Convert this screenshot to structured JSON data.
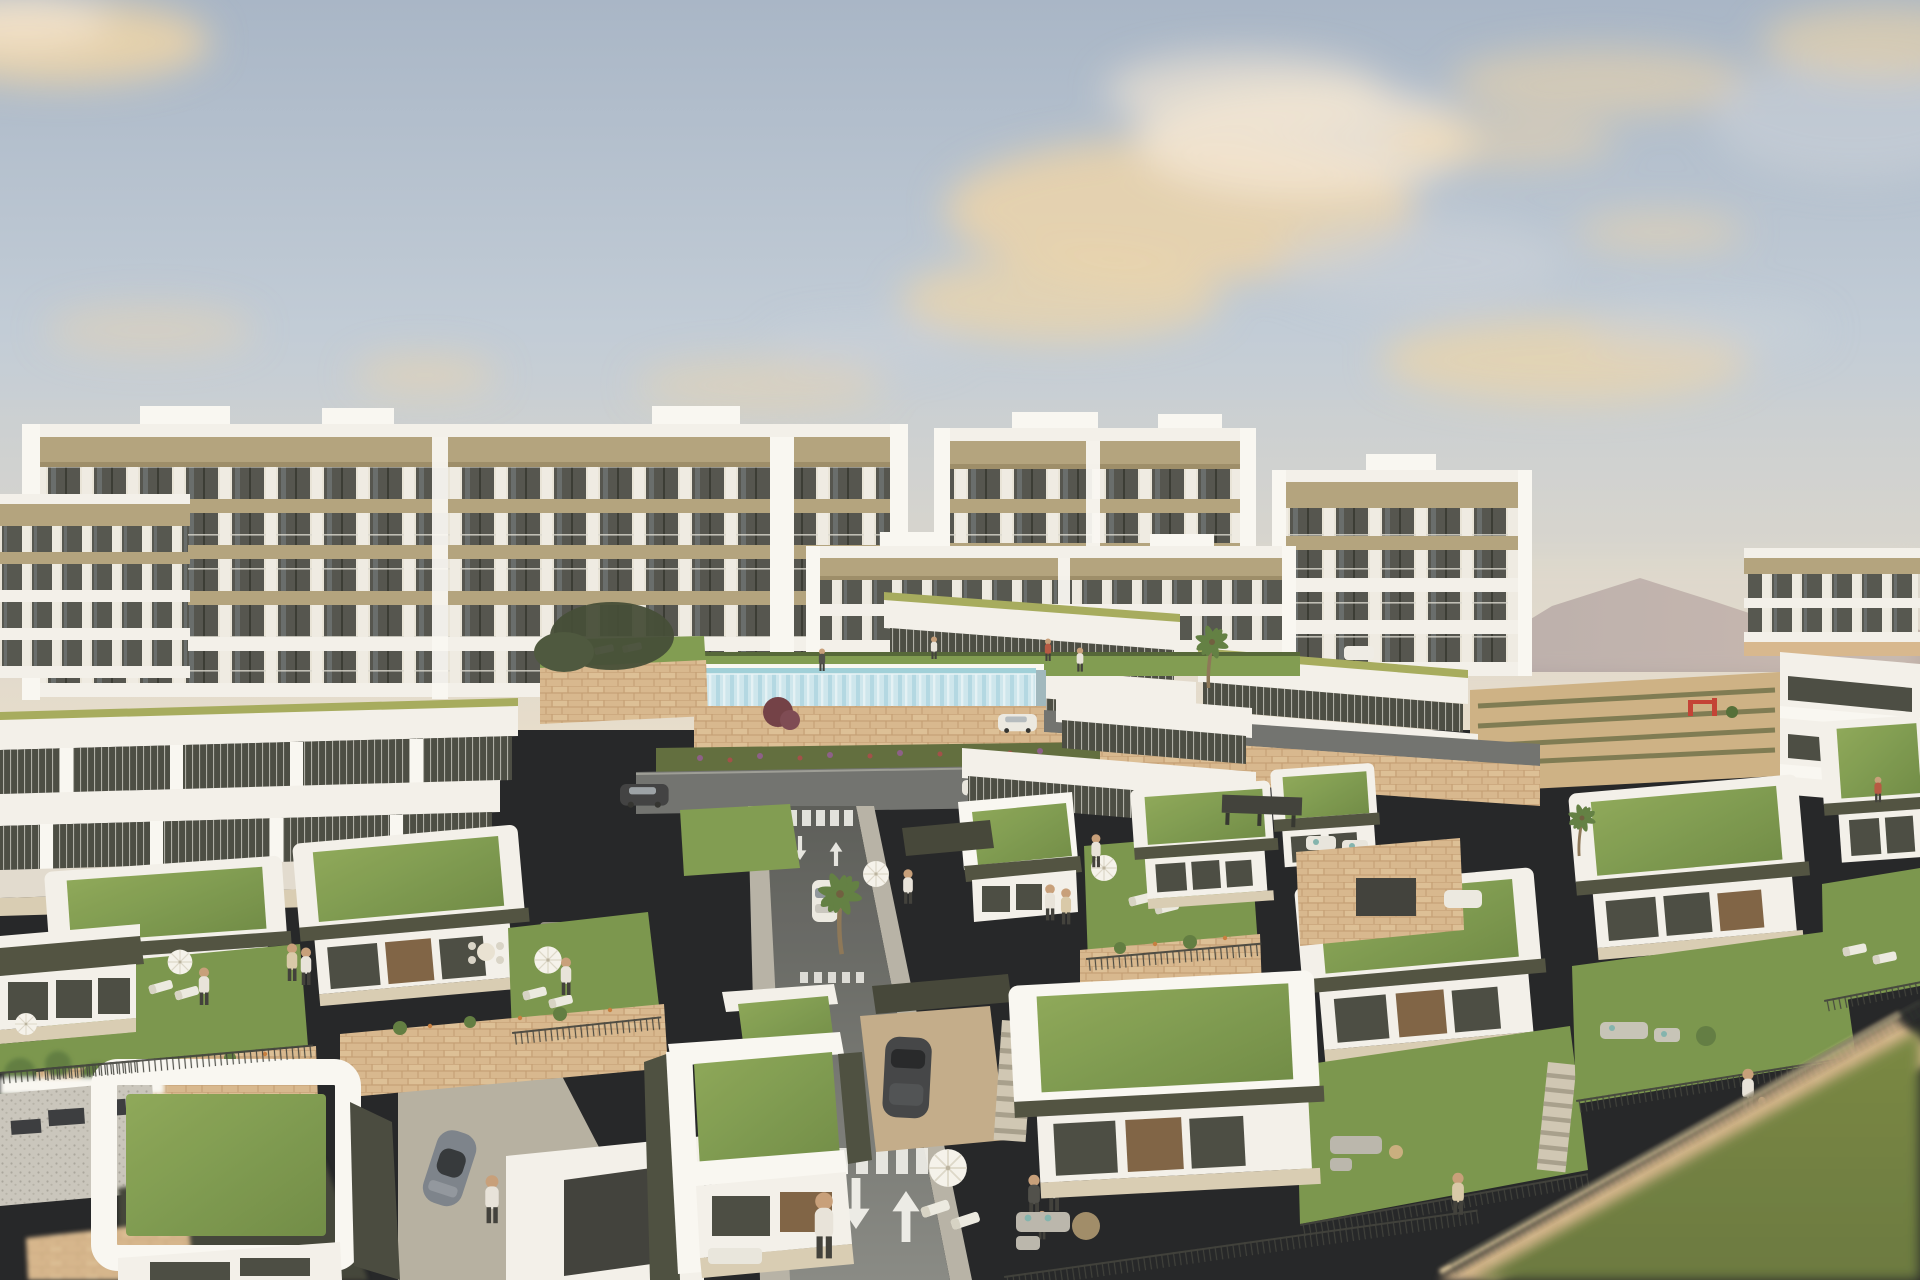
{
  "scene": {
    "title": "Aerial architectural rendering of a hillside residential resort at golden hour",
    "type": "3D exterior visualization",
    "time_of_day": "late afternoon, golden hour",
    "weather": "partly cloudy with warm-lit clouds",
    "view": "elevated three-quarter aerial view"
  },
  "palette": {
    "sky_top": "#a9b6c6",
    "sky_mid": "#c2ccd6",
    "sky_low": "#d9d6cf",
    "sky_horizon": "#e7decd",
    "cloud_warm": "#efd5a7",
    "cloud_bright": "#f5e7d3",
    "cloud_grey": "#ccd2d9",
    "mountain": "#9f9097",
    "mountain_far": "#b4a39f",
    "white_wall": "#f4f2ec",
    "white_bright": "#faf9f5",
    "wall_shade": "#e2dcd0",
    "khaki_band": "#b1a27c",
    "khaki_dark": "#9a8b66",
    "lime_trim": "#a4aa5a",
    "olive_fascia": "#4b4d3d",
    "glass_dark": "#45473f",
    "glass_frame": "#e9e5da",
    "stone": "#d7b78d",
    "stone_dark": "#bf9d72",
    "lawn": "#7d9a4d",
    "lawn_dark": "#647f3b",
    "garden": "#769449",
    "road": "#6d6f6d",
    "road_dark": "#565855",
    "sidewalk": "#b6b2a6",
    "paving": "#c2ab88",
    "court": "#b5afa1",
    "pool_water": "#9ed0db",
    "pool_glass": "#cde7f0",
    "fence": "#3b3d38",
    "marking": "#f2f2ee",
    "skin": "#c79d78",
    "blur_lawn": "#75853f",
    "blur_lawn_dark": "#66763a"
  },
  "content": {
    "background": [
      "white apartment blocks with tiered balconies and khaki fascias",
      "hazy mountain ridges",
      "small hillside houses"
    ],
    "midground": [
      "terraced apartments with lime-green roof trim",
      "glass-walled infinity lap pool",
      "stone retaining walls with flower beds",
      "access road with painted lane arrows and crosswalks",
      "parked and moving cars",
      "palm trees"
    ],
    "foreground": [
      "modern single-storey villas with planted green roofs and white parapets",
      "private lawns with parasols, sun loungers and outdoor sofas",
      "residents walking and playing",
      "out-of-focus lawn and stone wall in the bottom-right corner"
    ],
    "apartment_block_count": 7,
    "villa_count": 12,
    "vehicle_count": 9,
    "people_count": 21
  }
}
